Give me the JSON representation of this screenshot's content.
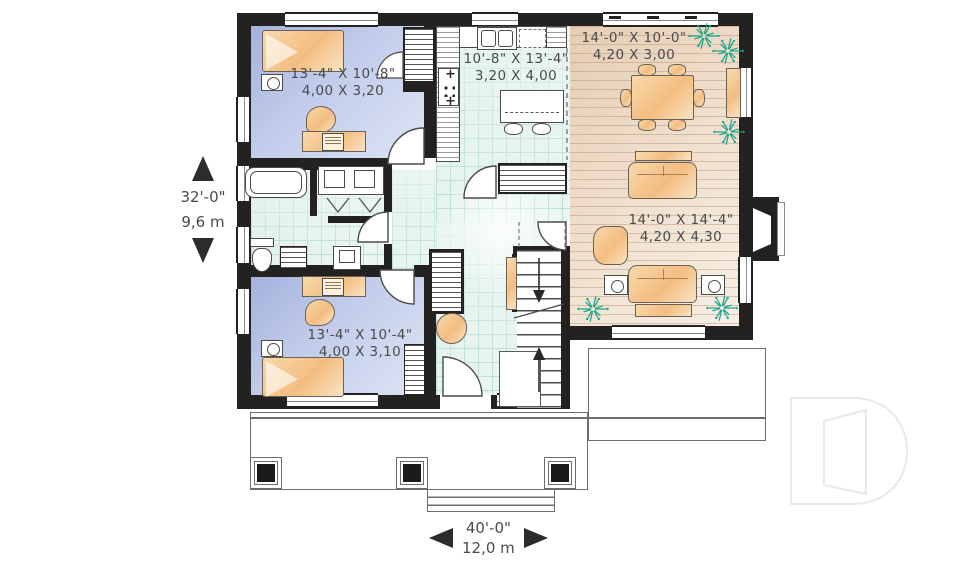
{
  "plan": {
    "rooms": {
      "bedroom_top": {
        "imperial": "13'-4\" X 10'-8\"",
        "metric": "4,00 X 3,20"
      },
      "kitchen": {
        "imperial": "10'-8\" X 13'-4\"",
        "metric": "3,20 X 4,00"
      },
      "dining": {
        "imperial": "14'-0\" X 10'-0\"",
        "metric": "4,20 X 3,00"
      },
      "living": {
        "imperial": "14'-0\" X 14'-4\"",
        "metric": "4,20 X 4,30"
      },
      "bedroom_bottom": {
        "imperial": "13'-4\" X 10'-4\"",
        "metric": "4,00 X 3,10"
      }
    },
    "overall": {
      "depth": {
        "imperial": "32'-0\"",
        "metric": "9,6 m"
      },
      "width": {
        "imperial": "40'-0\"",
        "metric": "12,0 m"
      }
    }
  },
  "icons": {
    "stove_plus": "+",
    "dimension_vertical": "up-down-arrows",
    "dimension_horizontal": "left-right-arrows",
    "plant": "starburst-shrub",
    "logo": "letter-d-outline-watermark"
  },
  "colors": {
    "wall": "#242220",
    "bedroom_floor": "#b3c0e4",
    "tile_floor": "#cfe9e2",
    "wood_floor": "#ecd9c4",
    "furniture": "#f6c992",
    "plant": "#14a38a",
    "text": "#4a4a4c",
    "logo": "#e9e9e9"
  }
}
